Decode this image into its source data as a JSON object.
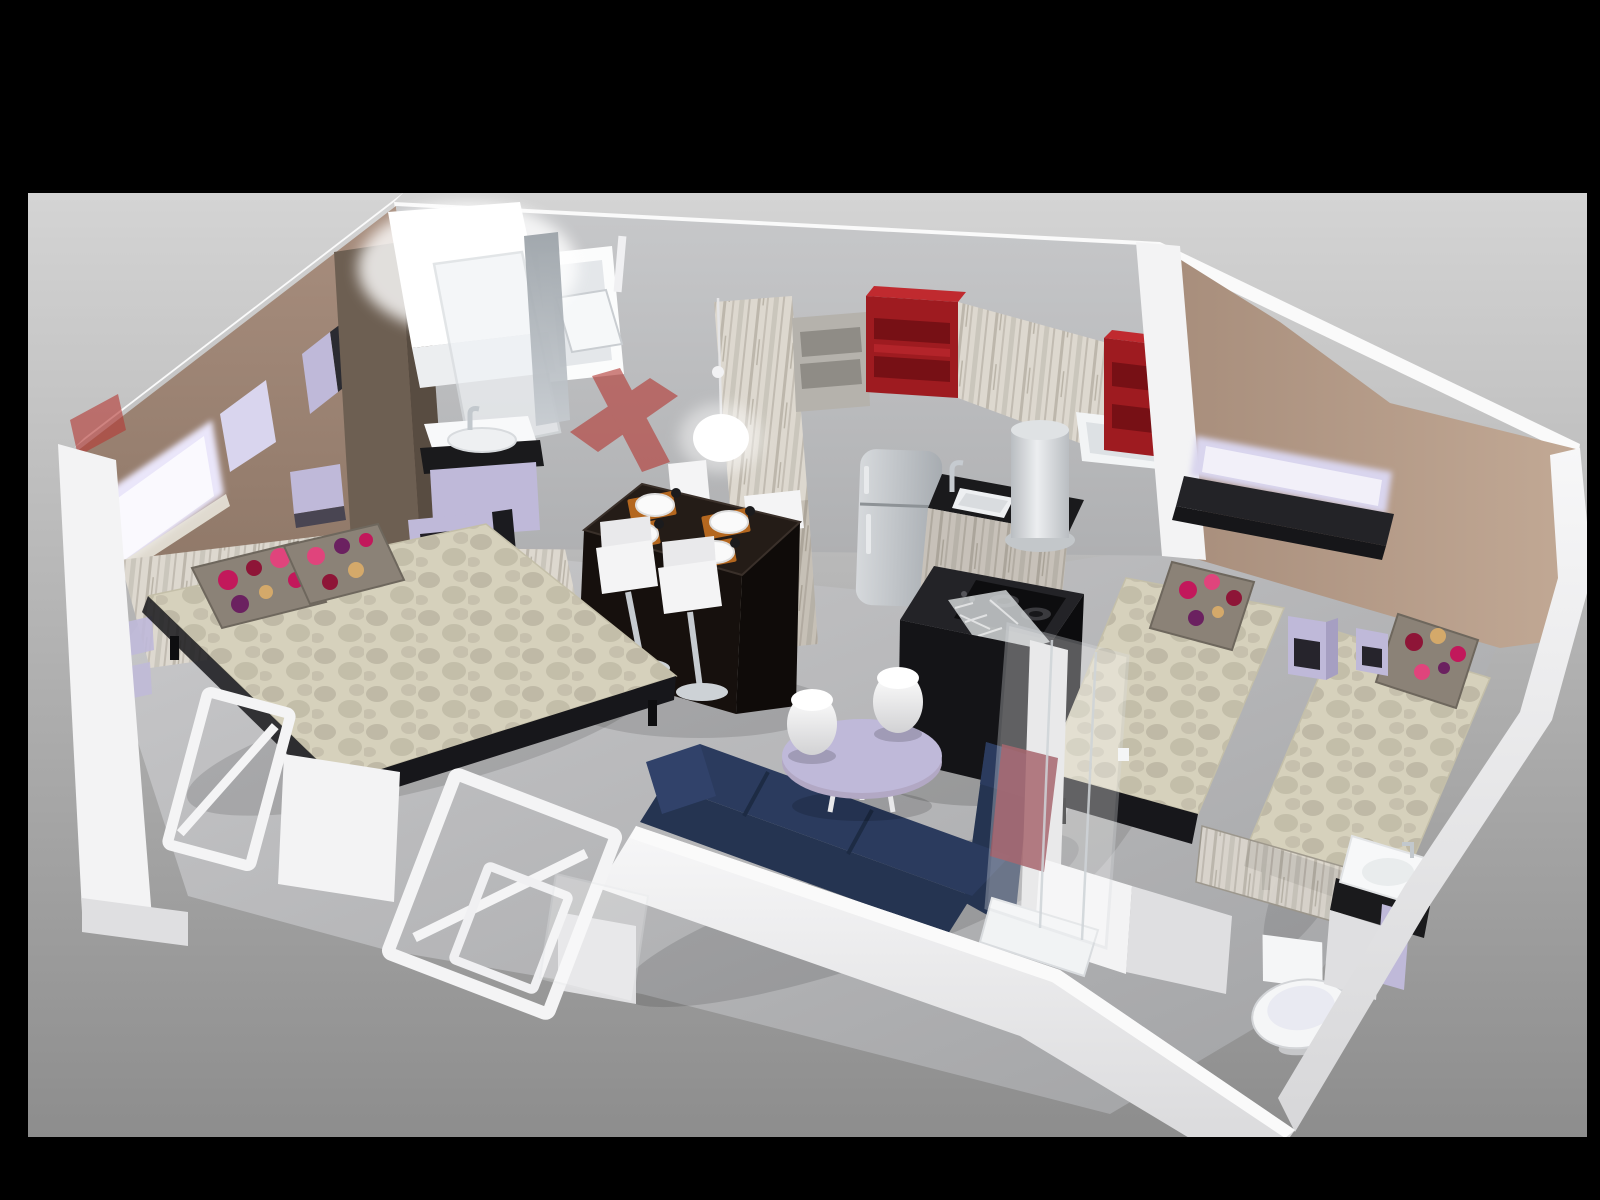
{
  "image": {
    "kind": "3D cutaway dollhouse floor-plan render",
    "width": 1600,
    "height": 1200,
    "backdrop": "studio gray gradient with black letterbox frame"
  },
  "scene": {
    "rooms": [
      {
        "name": "master-bedroom",
        "items": [
          "double bed with patterned beige cover",
          "two polka-dot accent pillows",
          "whitewashed wood headboard wall",
          "illuminated lavender wall niche",
          "wall cubby shelves",
          "lavender side shelf"
        ]
      },
      {
        "name": "en-suite-bathroom",
        "items": [
          "glowing walk-in shower cabin",
          "glass door",
          "mirror",
          "washbasin vanity with black trim and lavender drawer",
          "open shelf unit",
          "tilting window"
        ]
      },
      {
        "name": "kitchen",
        "items": [
          "weathered wood wall cabinets",
          "two red open shelf boxes",
          "gray open cubby",
          "stainless refrigerator",
          "black countertop with inset sink and chrome faucet",
          "cylindrical water heater",
          "second window",
          "black island with gas hob"
        ]
      },
      {
        "name": "dining-area",
        "items": [
          "dark dining table",
          "four place settings with white plates and orange mats",
          "four white bar stools with chrome pedestals",
          "white pendant lamp"
        ]
      },
      {
        "name": "living-area",
        "items": [
          "navy corner sofa",
          "lavender oval coffee table",
          "two white egg stools"
        ]
      },
      {
        "name": "twin-bedroom",
        "items": [
          "two single beds with patterned covers",
          "polka-dot pillows",
          "black wall shelf with lavender light strip",
          "two lavender open nightstands"
        ]
      },
      {
        "name": "shower-room",
        "items": [
          "glass shower cabin with red panel",
          "white shower tray",
          "toilet",
          "washbasin with black counter and lavender cabinet",
          "white partition walls"
        ]
      }
    ],
    "annotations": [
      "translucent red cut-section markers where walls are removed",
      "leaning white door frames along the open cutaway edge"
    ]
  },
  "colors": {
    "frame": "#000000",
    "backdrop_top": "#d4d4d4",
    "backdrop_bottom": "#8d8d8d",
    "floor_light": "#c9c9cb",
    "floor_dark": "#a0a1a3",
    "wall_white": "#f3f3f4",
    "wall_white_shade": "#dfdfe1",
    "wall_top_strip": "#fafafa",
    "white_wall_grad_a": "#f7f7f8",
    "white_wall_grad_b": "#d7d7d9",
    "gray_wall_top": "#c7c8ca",
    "gray_wall_bottom": "#afb0b2",
    "taupe_top": "#a88e7e",
    "taupe_bottom": "#8d7666",
    "tan_light": "#c2a995",
    "tan_dark": "#a78d7b",
    "wardrobe_dark": "#6d5f52",
    "wardrobe_darker": "#584c41",
    "wood_base": "#ddd8cf",
    "wood_streak": "#b5afa4",
    "red_shelf": "#9e1b20",
    "red_shelf_top": "#c02a2f",
    "red_shelf_inner": "#771015",
    "red_shelf_lip": "#b3242a",
    "red_marker": "#b43a35",
    "red_glass": "#7e1f2a",
    "lavender": "#bfb9d9",
    "lavender_light": "#d9d5ee",
    "lavender_glow": "#eae6fa",
    "black_counter": "#1a1a1c",
    "island_black": "#141417",
    "stove_black": "#0d0d0f",
    "steel_mid": "#b9bdc1",
    "chrome": "#cdd2d6",
    "fridge_light": "#d6d9dc",
    "fridge_dark": "#a7acb1",
    "bed_cover": "#d6d1bc",
    "bed_pattern": "#b6b09d",
    "bed_base": "#17171b",
    "pillow_base": "#8b8277",
    "dot_pink": "#c2185b",
    "dot_magenta": "#e0447c",
    "dot_crimson": "#8e1537",
    "dot_purple": "#6b2160",
    "dot_tan": "#d4a96a",
    "sofa_top": "#2b3b5e",
    "sofa_mid": "#253451",
    "sofa_dark": "#1d2b44",
    "table_top": "#241c17",
    "table_side": "#16100d",
    "placemat": "#b4671f",
    "plate_white": "#fafafa",
    "stool_white": "#f4f4f5",
    "toilet_white": "#f5f6f7",
    "mirror_top": "#9aa1a7",
    "mirror_bottom": "#c6cbd0",
    "window_pane": "#e4e7ea",
    "cubby_gray": "#b5b2ac",
    "cubby_shelf": "#8f8c86",
    "shelf_black": "#232327"
  }
}
